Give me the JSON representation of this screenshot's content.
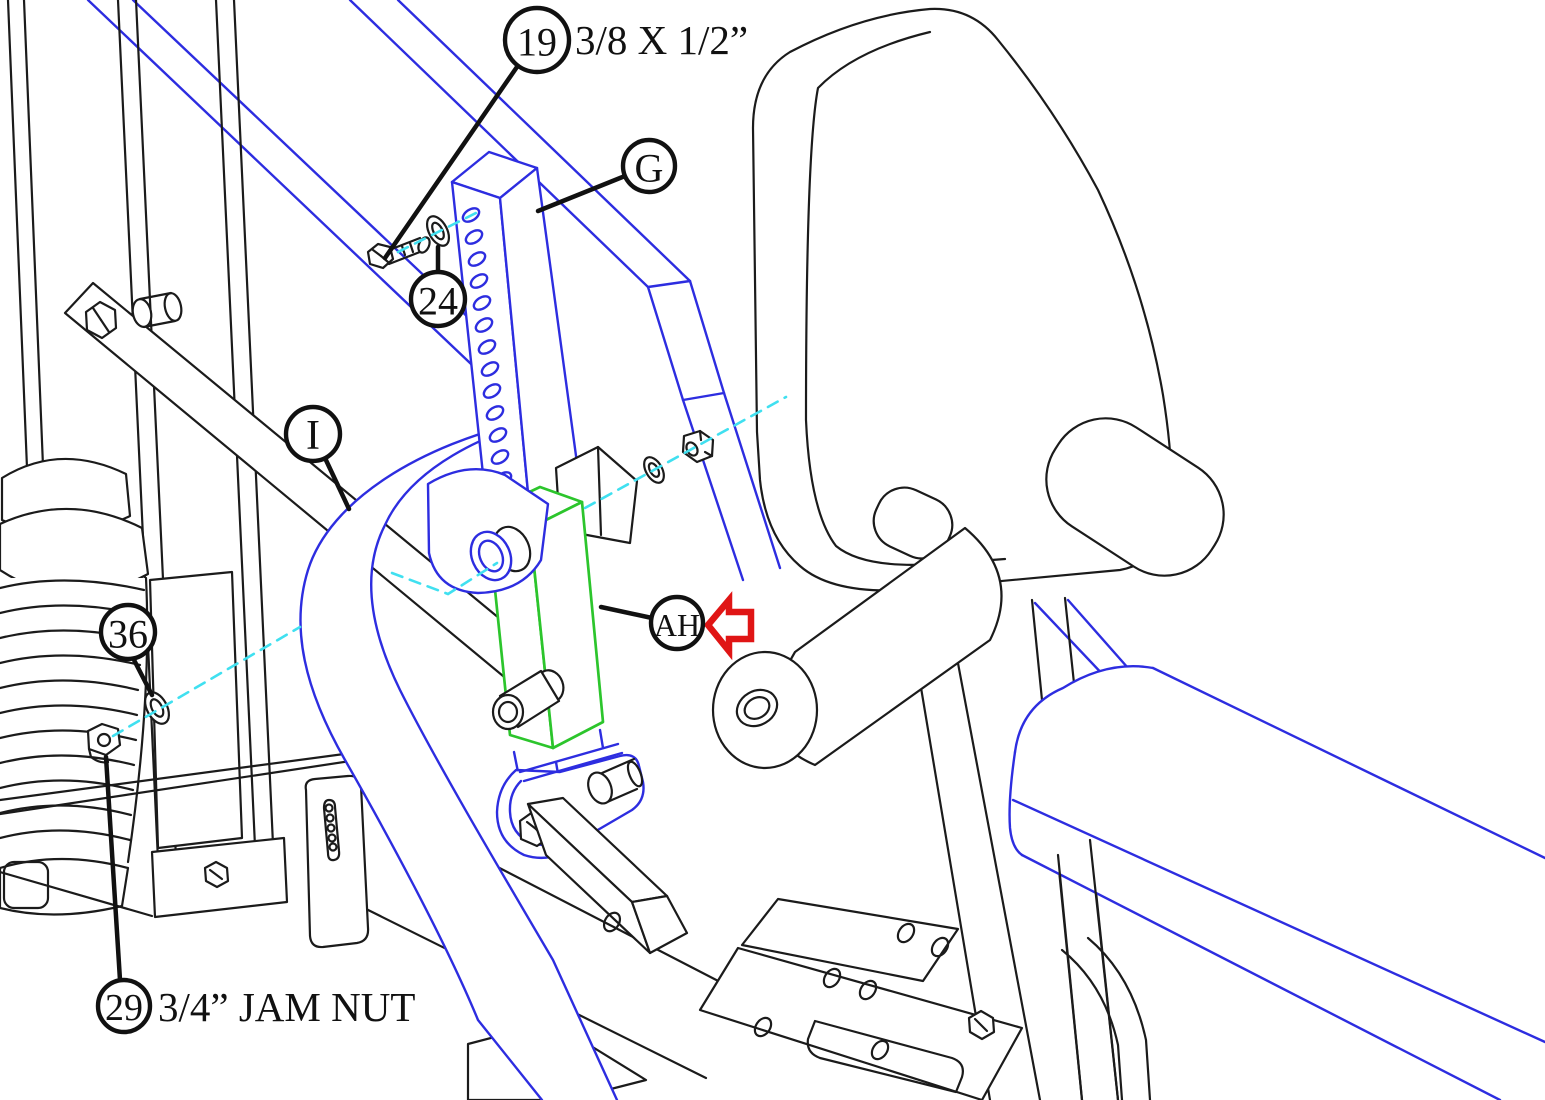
{
  "diagram": {
    "type": "exploded-assembly-diagram",
    "subject": "home gym press-arm adjustment bar assembly",
    "background": "#ffffff",
    "colors": {
      "frame_blue": "#2d2de0",
      "outline_black": "#1b1b1b",
      "highlight_green": "#2cc52c",
      "centerline_cyan": "#40e0f0",
      "arrow_red": "#e01515"
    },
    "highlighted_part_id": "AH",
    "callouts": [
      {
        "id": "19",
        "label": "19",
        "annotation": "3/8 X 1/2”"
      },
      {
        "id": "24",
        "label": "24",
        "annotation": ""
      },
      {
        "id": "G",
        "label": "G",
        "annotation": ""
      },
      {
        "id": "I",
        "label": "I",
        "annotation": ""
      },
      {
        "id": "36",
        "label": "36",
        "annotation": ""
      },
      {
        "id": "29",
        "label": "29",
        "annotation": "3/4” JAM NUT"
      },
      {
        "id": "AH",
        "label": "AH",
        "annotation": "",
        "pointer": "red-left-arrow"
      }
    ]
  }
}
